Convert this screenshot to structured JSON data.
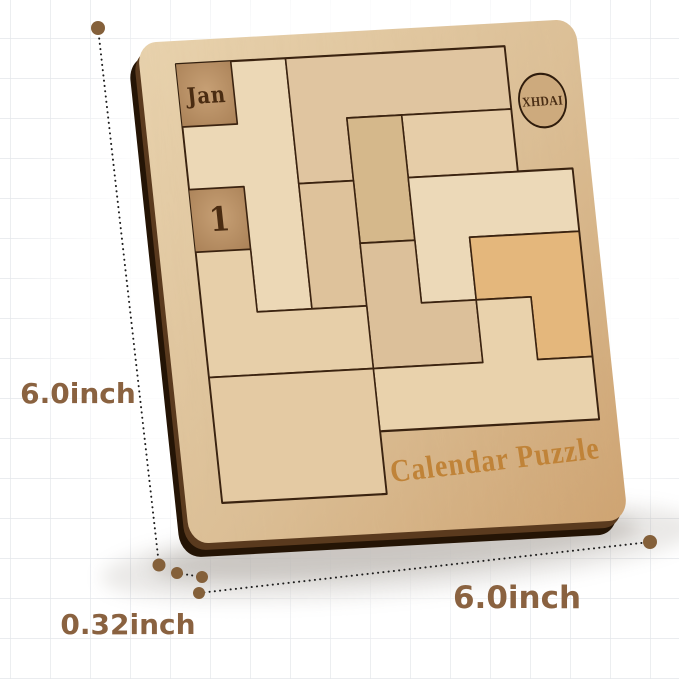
{
  "product": {
    "type": "wooden calendar puzzle product photo",
    "month_label": "Jan",
    "day_label": "1",
    "brand": "XHDAI",
    "engraving": "Calendar Puzzle"
  },
  "dimensions": {
    "height_label": "6.0inch",
    "width_label": "6.0inch",
    "thickness_label": "0.32inch"
  },
  "colors": {
    "dimension_text": "#8a6240",
    "dimension_dot": "#84603a",
    "dimension_line": "#1d1d1d",
    "board_frame_light": "#e8d2ad",
    "board_frame_dark": "#d0a97b",
    "tray_floor": "#bb946a",
    "hole_floor": "#bd9769",
    "engraving_dark": "#4a2c12",
    "brand_engraving": "#c08338",
    "piece_orange": "#e4b77c",
    "piece_light": "#ecd8b6",
    "board_side": "#241405",
    "grid_line": "#e3e6ea"
  }
}
